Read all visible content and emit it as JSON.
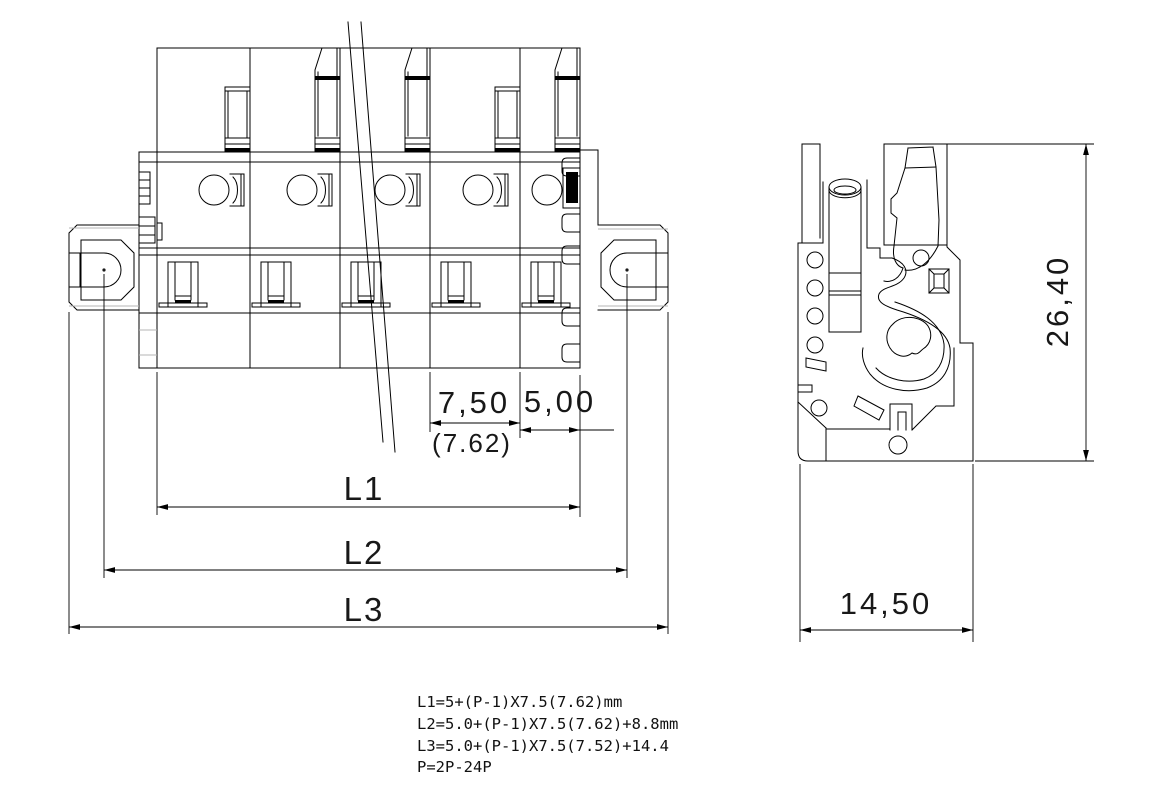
{
  "dimensions": {
    "pitch_label": "7,50",
    "pitch_alt_label": "(7.62)",
    "end_offset_label": "5,00",
    "length1_label": "L1",
    "length2_label": "L2",
    "length3_label": "L3",
    "height_label": "26,40",
    "depth_label": "14,50"
  },
  "notes": {
    "line1": "L1=5+(P-1)X7.5(7.62)mm",
    "line2": "L2=5.0+(P-1)X7.5(7.62)+8.8mm",
    "line3": "L3=5.0+(P-1)X7.5(7.52)+14.4",
    "line4": "P=2P-24P"
  },
  "colors": {
    "line": "#000000",
    "accent_gray": "#b4b4b4",
    "background": "#ffffff"
  }
}
